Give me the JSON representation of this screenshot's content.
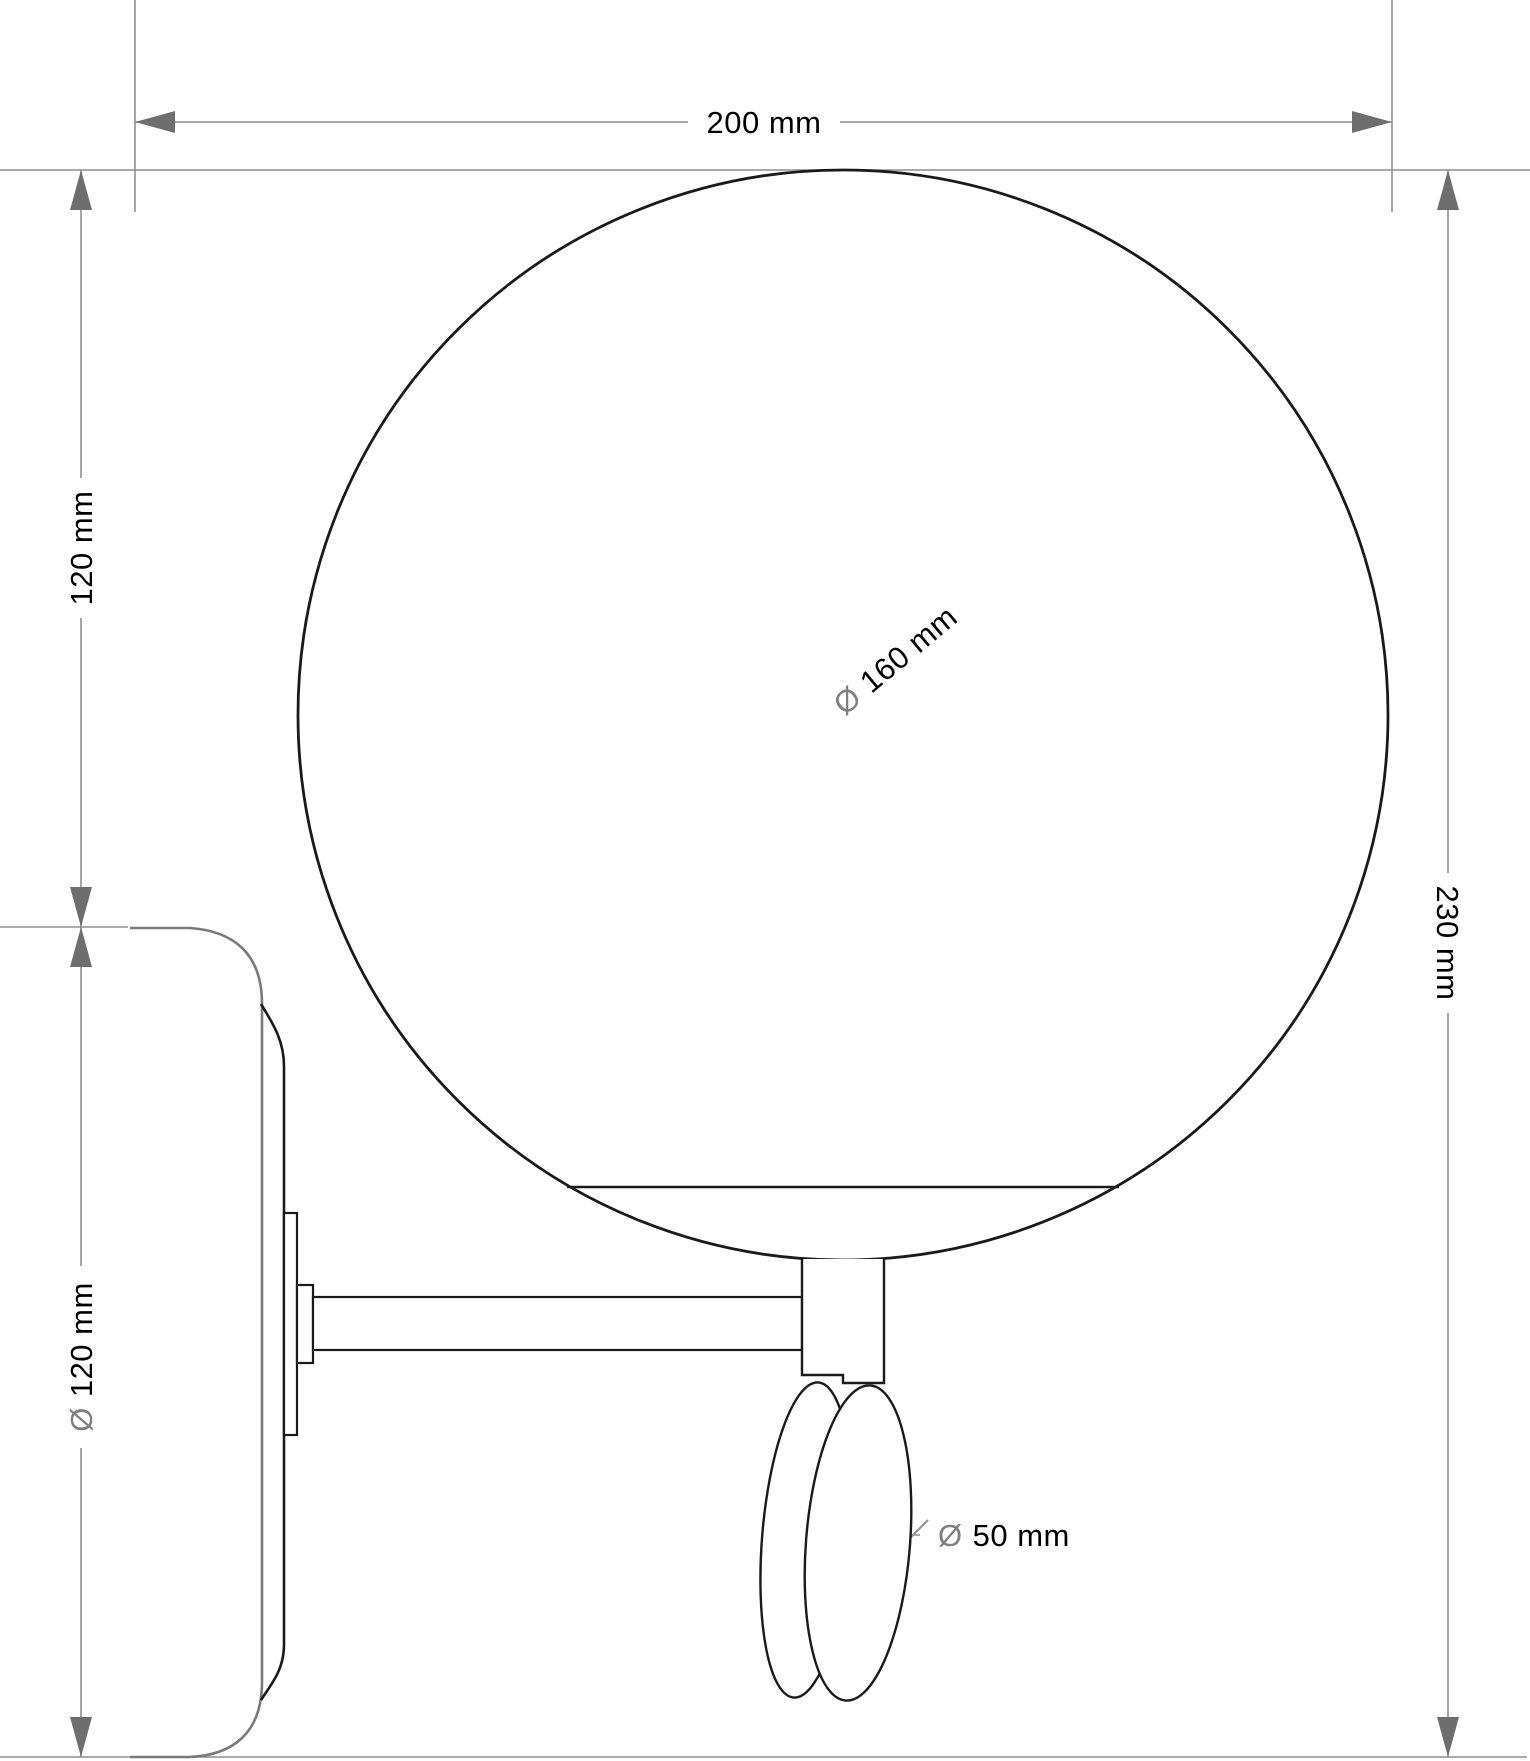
{
  "drawing": {
    "kind": "wall-lamp-technical-drawing",
    "units": "mm"
  },
  "dimensions": {
    "overall_width": {
      "label": "200 mm"
    },
    "upper_height": {
      "label": "120 mm"
    },
    "total_height": {
      "label": "230 mm"
    },
    "globe_diameter": {
      "symbol": "Ø",
      "value": "160 mm"
    },
    "plate_diameter": {
      "symbol": "Ø",
      "value": "120 mm"
    },
    "grip_diameter": {
      "symbol": "Ø",
      "value": "50 mm"
    }
  },
  "colors": {
    "background": "#ffffff",
    "drawing_line": "#1a1a1a",
    "plate_line": "#7a7a7a",
    "dimension_line": "#8f8f8f",
    "arrow_fill": "#6e6e6e",
    "label_text": "#000000",
    "diameter_symbol": "#7f7f7f"
  }
}
